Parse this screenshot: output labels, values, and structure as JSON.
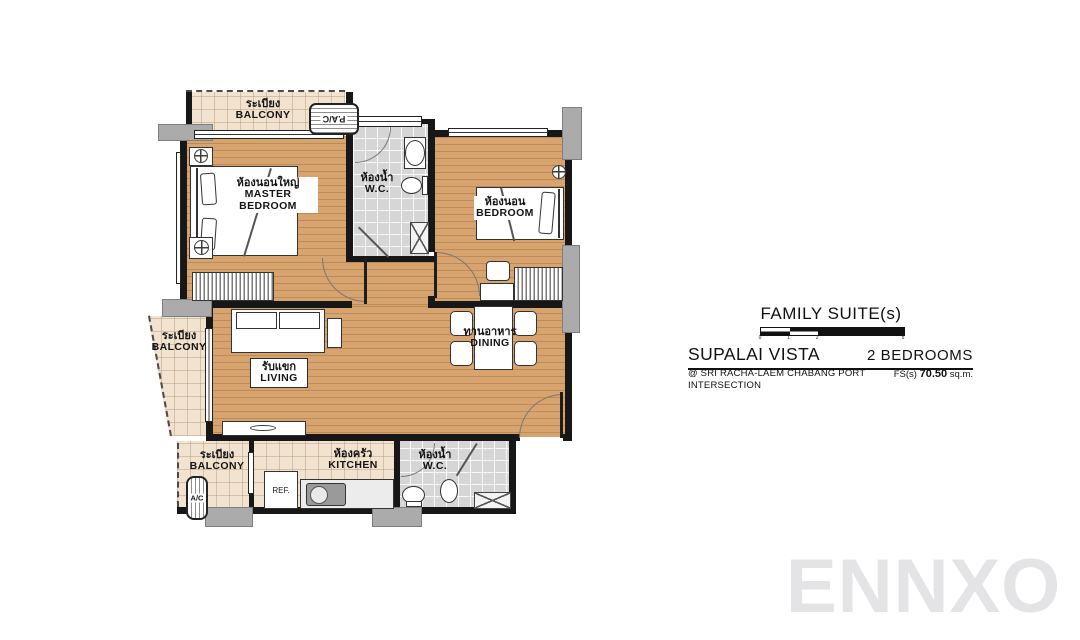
{
  "plan": {
    "balcony_top": {
      "thai": "ระเบียง",
      "en": "BALCONY"
    },
    "master_bedroom": {
      "thai": "ห้องนอนใหญ่",
      "en_line1": "MASTER",
      "en_line2": "BEDROOM"
    },
    "wc_top": {
      "thai": "ห้องน้ำ",
      "en": "W.C."
    },
    "bedroom": {
      "thai": "ห้องนอน",
      "en": "BEDROOM"
    },
    "balcony_left": {
      "thai": "ระเบียง",
      "en": "BALCONY"
    },
    "living": {
      "thai": "รับแขก",
      "en": "LIVING"
    },
    "dining": {
      "thai": "ทานอาหาร",
      "en": "DINING"
    },
    "balcony_bottom": {
      "thai": "ระเบียง",
      "en": "BALCONY"
    },
    "kitchen": {
      "thai": "ห้องครัว",
      "en": "KITCHEN"
    },
    "wc_bottom": {
      "thai": "ห้องน้ำ",
      "en": "W.C."
    },
    "equipment": {
      "ac_unit_top": "P.A/C",
      "ac_unit_bottom": "A/C",
      "refrigerator": "REF."
    }
  },
  "info": {
    "type_title": "FAMILY SUITE(s)",
    "scale_ticks": [
      "0",
      "1",
      "2",
      "5"
    ],
    "project_name": "SUPALAI VISTA",
    "unit_type": "2 BEDROOMS",
    "location_line1": "@ SRI RACHA-LAEM CHABANG PORT",
    "location_line2": "INTERSECTION",
    "area_label": "FS(s)",
    "area_value": "70.50",
    "area_unit": "sq.m."
  },
  "watermark": "ENNXO",
  "colors": {
    "wood_floor": "#d7a46f",
    "balcony_tile": "#f2e3d1",
    "wc_tile": "#d6d6d6",
    "wall": "#171717",
    "column": "#ababab",
    "watermark": "#e4e4e6"
  }
}
